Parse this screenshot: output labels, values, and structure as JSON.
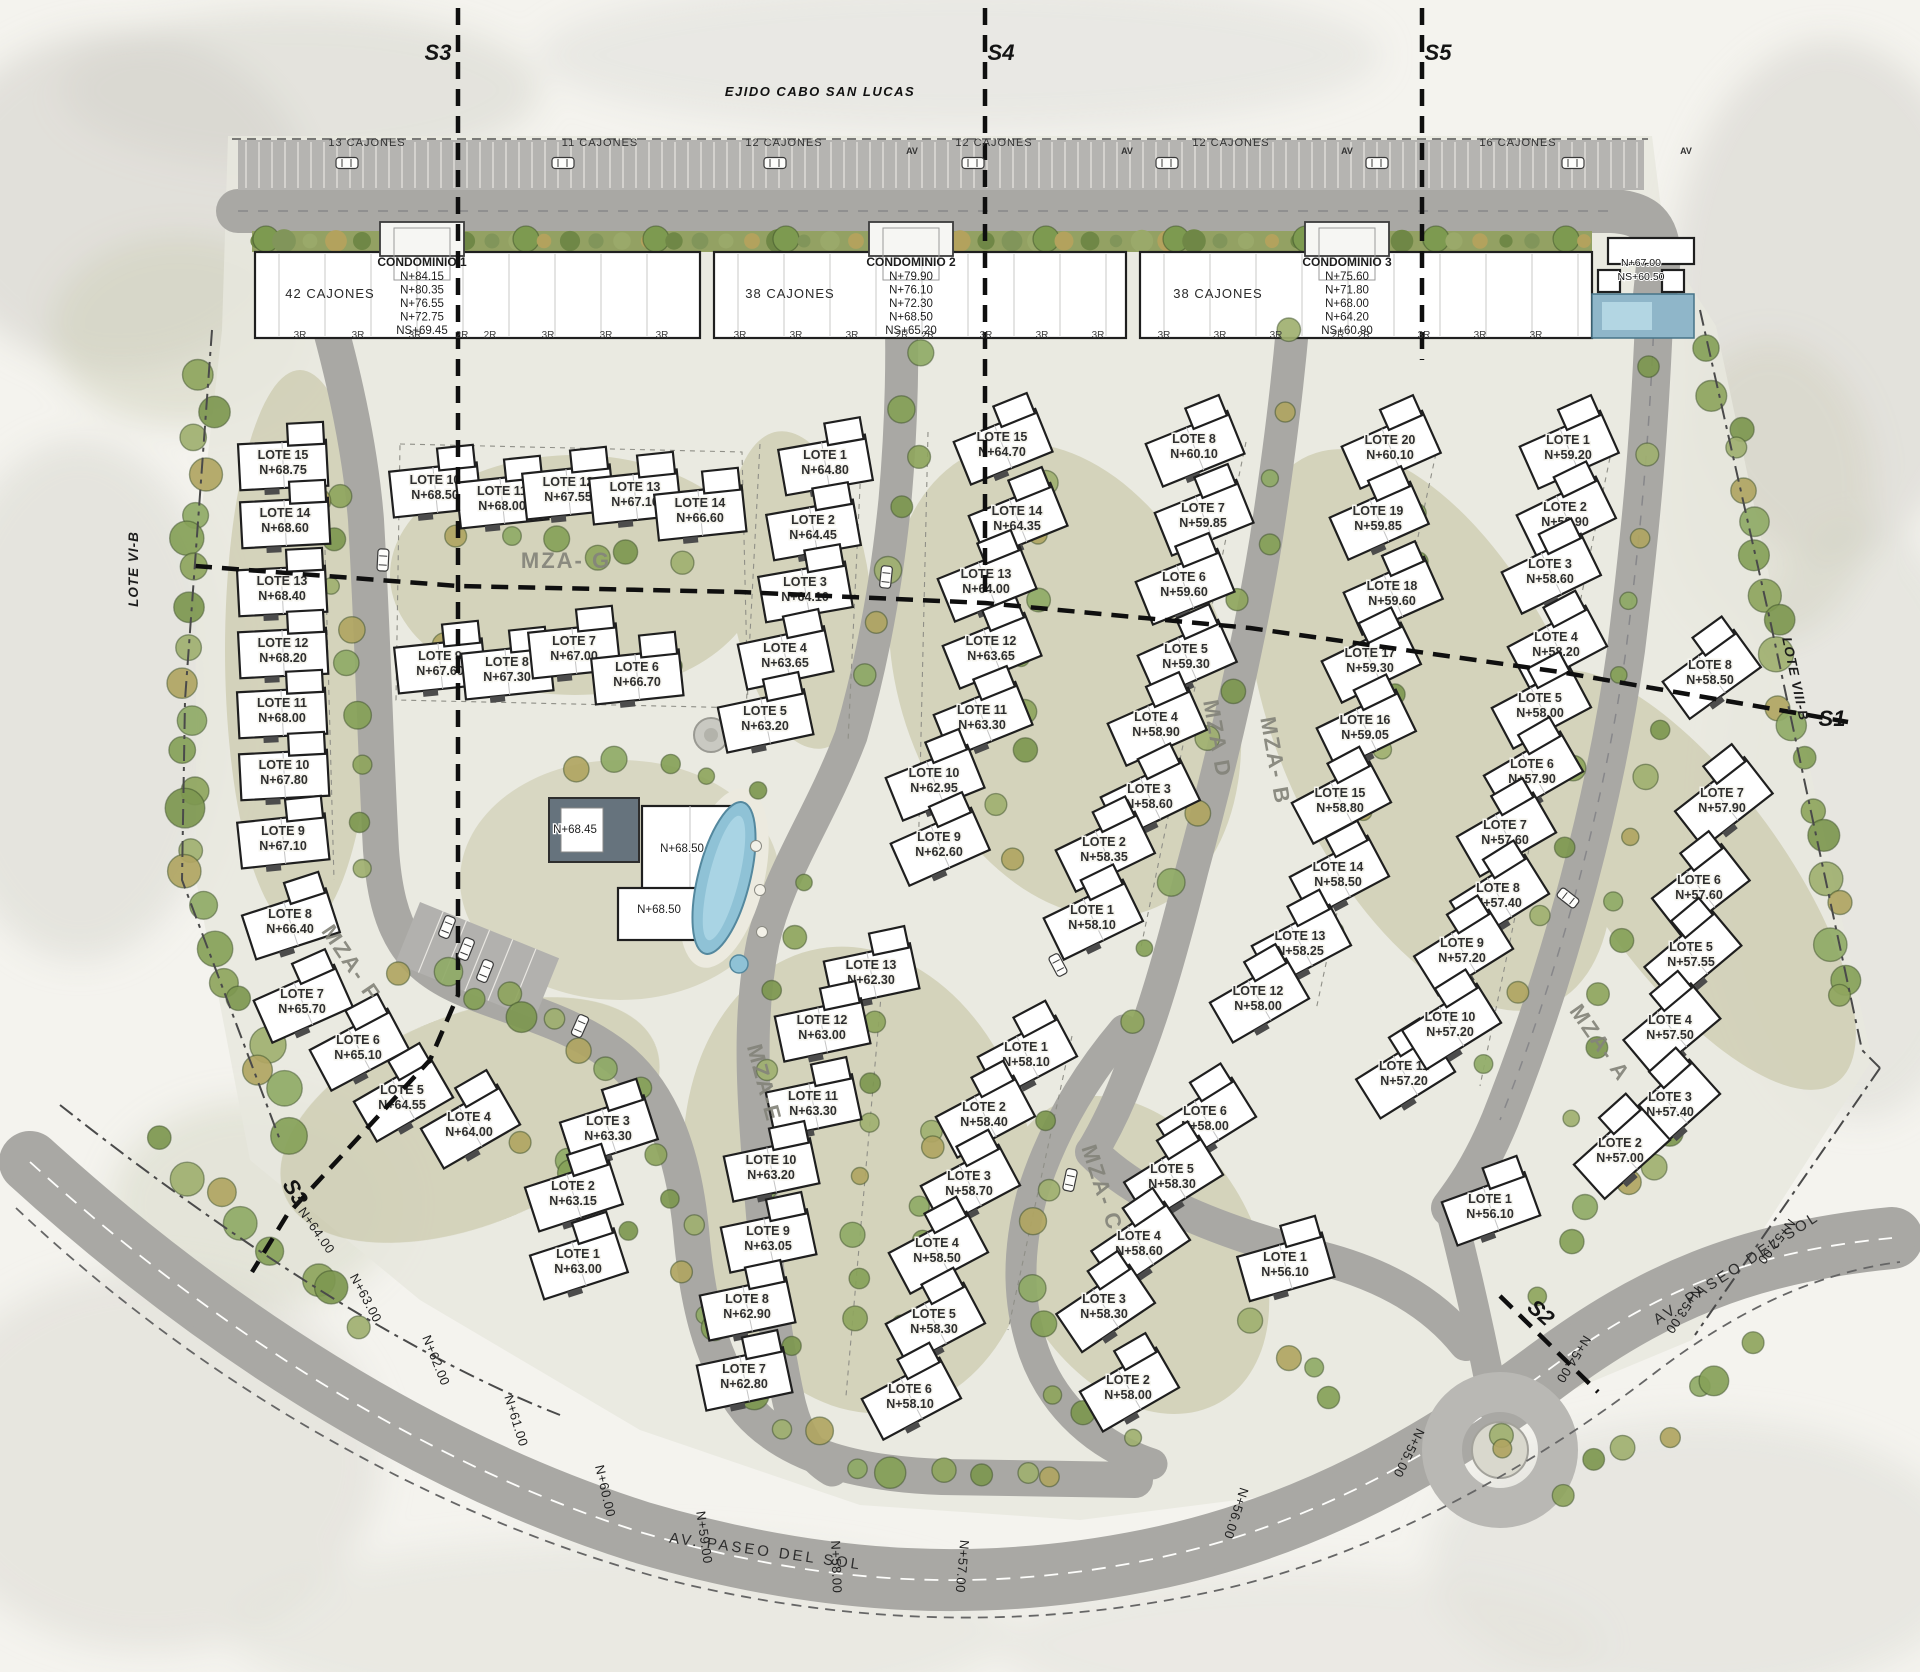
{
  "title": "EJIDO CABO SAN LUCAS",
  "colors": {
    "road": "#a9a8a4",
    "boulevard": "#b9b8b4",
    "pool_blue": "#8fc2d6",
    "tree_green": "#8fa55e",
    "building_white": "#ffffff"
  },
  "sections": [
    {
      "id": "S3-top",
      "label": "S3",
      "x": 438,
      "y": 60,
      "rot": 0
    },
    {
      "id": "S4-top",
      "label": "S4",
      "x": 1001,
      "y": 60,
      "rot": 0
    },
    {
      "id": "S5-top",
      "label": "S5",
      "x": 1438,
      "y": 60,
      "rot": 0
    },
    {
      "id": "S1-east",
      "label": "S1",
      "x": 1832,
      "y": 726,
      "rot": 0
    },
    {
      "id": "S2-south",
      "label": "S2",
      "x": 1536,
      "y": 1318,
      "rot": 42
    },
    {
      "id": "S3-bottom",
      "label": "S3",
      "x": 289,
      "y": 1196,
      "rot": 58
    }
  ],
  "boundaries": [
    {
      "label": "LOTE VI-B",
      "x": 138,
      "y": 569,
      "rot": -90
    },
    {
      "label": "LOTE VIII-B",
      "x": 1791,
      "y": 680,
      "rot": 78
    }
  ],
  "parking": {
    "row_y": 146,
    "labels": [
      {
        "text": "13 CAJONES",
        "x": 367
      },
      {
        "text": "11 CAJONES",
        "x": 600
      },
      {
        "text": "12 CAJONES",
        "x": 784
      },
      {
        "text": "12 CAJONES",
        "x": 994
      },
      {
        "text": "12 CAJONES",
        "x": 1231
      },
      {
        "text": "16 CAJONES",
        "x": 1518
      }
    ],
    "av_markers": [
      {
        "text": "AV",
        "x": 912
      },
      {
        "text": "AV",
        "x": 1127
      },
      {
        "text": "AV",
        "x": 1347
      },
      {
        "text": "AV",
        "x": 1686
      }
    ]
  },
  "condominiums": [
    {
      "name": "CONDOMINIO 1",
      "cajones_label": "42 CAJONES",
      "tower_x": 422,
      "cajones_x": 330,
      "levels": [
        "N+84.15",
        "N+80.35",
        "N+76.55",
        "N+72.75",
        "NS+69.45"
      ]
    },
    {
      "name": "CONDOMINIO 2",
      "cajones_label": "38 CAJONES",
      "tower_x": 911,
      "cajones_x": 790,
      "levels": [
        "N+79.90",
        "N+76.10",
        "N+72.30",
        "N+68.50",
        "NS+65.20"
      ]
    },
    {
      "name": "CONDOMINIO 3",
      "cajones_label": "38 CAJONES",
      "tower_x": 1347,
      "cajones_x": 1218,
      "levels": [
        "N+75.60",
        "N+71.80",
        "N+68.00",
        "N+64.20",
        "NS+60.90"
      ]
    }
  ],
  "floor_marks": {
    "y": 338,
    "items": [
      {
        "t": "3R",
        "x": 300
      },
      {
        "t": "3R",
        "x": 358
      },
      {
        "t": "3R",
        "x": 415
      },
      {
        "t": "2R",
        "x": 462
      },
      {
        "t": "2R",
        "x": 490
      },
      {
        "t": "3R",
        "x": 548
      },
      {
        "t": "3R",
        "x": 606
      },
      {
        "t": "3R",
        "x": 662
      },
      {
        "t": "3R",
        "x": 740
      },
      {
        "t": "3R",
        "x": 796
      },
      {
        "t": "3R",
        "x": 852
      },
      {
        "t": "2R",
        "x": 902
      },
      {
        "t": "2R",
        "x": 928
      },
      {
        "t": "3R",
        "x": 986
      },
      {
        "t": "3R",
        "x": 1042
      },
      {
        "t": "3R",
        "x": 1098
      },
      {
        "t": "3R",
        "x": 1164
      },
      {
        "t": "3R",
        "x": 1220
      },
      {
        "t": "3R",
        "x": 1276
      },
      {
        "t": "2R",
        "x": 1338
      },
      {
        "t": "2R",
        "x": 1364
      },
      {
        "t": "3R",
        "x": 1424
      },
      {
        "t": "3R",
        "x": 1480
      },
      {
        "t": "3R",
        "x": 1536
      }
    ]
  },
  "corner_building": {
    "x": 1641,
    "y": 266,
    "levels": [
      "N+67.00",
      "NS+60.50"
    ]
  },
  "amenity_labels": [
    {
      "text": "N+68.45",
      "x": 575,
      "y": 833
    },
    {
      "text": "N+68.50",
      "x": 682,
      "y": 852
    },
    {
      "text": "N+68.50",
      "x": 659,
      "y": 913
    }
  ],
  "manzanas": [
    {
      "name": "MZA- F",
      "label": {
        "x": 345,
        "y": 967,
        "rot": 56
      },
      "lots": [
        [
          15,
          "N+68.75",
          283,
          462,
          -3
        ],
        [
          14,
          "N+68.60",
          285,
          520,
          -3
        ],
        [
          13,
          "N+68.40",
          282,
          588,
          -3
        ],
        [
          12,
          "N+68.20",
          283,
          650,
          -3
        ],
        [
          11,
          "N+68.00",
          282,
          710,
          -3
        ],
        [
          10,
          "N+67.80",
          284,
          772,
          -3
        ],
        [
          9,
          "N+67.10",
          283,
          838,
          -6
        ],
        [
          8,
          "N+66.40",
          290,
          921,
          -18
        ],
        [
          7,
          "N+65.70",
          302,
          1001,
          -24
        ],
        [
          6,
          "N+65.10",
          358,
          1047,
          -28
        ],
        [
          5,
          "N+64.55",
          402,
          1097,
          -30
        ],
        [
          4,
          "N+64.00",
          469,
          1124,
          -30
        ],
        [
          3,
          "N+63.30",
          608,
          1128,
          -18
        ],
        [
          2,
          "N+63.15",
          573,
          1193,
          -18
        ],
        [
          1,
          "N+63.00",
          578,
          1261,
          -18
        ]
      ]
    },
    {
      "name": "MZA- G",
      "label": {
        "x": 566,
        "y": 568,
        "rot": 0
      },
      "lots": [
        [
          10,
          "N+68.50",
          435,
          487,
          -6
        ],
        [
          11,
          "N+68.00",
          502,
          498,
          -6
        ],
        [
          12,
          "N+67.55",
          568,
          489,
          -6
        ],
        [
          13,
          "N+67.10",
          635,
          494,
          -6
        ],
        [
          14,
          "N+66.60",
          700,
          510,
          -6
        ],
        [
          9,
          "N+67.60",
          440,
          663,
          -6
        ],
        [
          8,
          "N+67.30",
          507,
          669,
          -6
        ],
        [
          7,
          "N+67.00",
          574,
          648,
          -6
        ],
        [
          6,
          "N+66.70",
          637,
          674,
          -6
        ],
        [
          1,
          "N+64.80",
          825,
          462,
          -10
        ],
        [
          2,
          "N+64.45",
          813,
          527,
          -10
        ],
        [
          3,
          "N+64.10",
          805,
          589,
          -10
        ],
        [
          4,
          "N+63.65",
          785,
          655,
          -12
        ],
        [
          5,
          "N+63.20",
          765,
          718,
          -12
        ]
      ]
    },
    {
      "name": "MZA D",
      "label": {
        "x": 1210,
        "y": 740,
        "rot": 80
      },
      "lots": [
        [
          15,
          "N+64.70",
          1002,
          444,
          -22
        ],
        [
          14,
          "N+64.35",
          1017,
          518,
          -22
        ],
        [
          13,
          "N+64.00",
          986,
          581,
          -22
        ],
        [
          12,
          "N+63.65",
          991,
          648,
          -22
        ],
        [
          11,
          "N+63.30",
          982,
          717,
          -22
        ],
        [
          10,
          "N+62.95",
          934,
          780,
          -22
        ],
        [
          9,
          "N+62.60",
          939,
          844,
          -24
        ],
        [
          8,
          "N+60.10",
          1194,
          446,
          -22
        ],
        [
          7,
          "N+59.85",
          1203,
          515,
          -22
        ],
        [
          6,
          "N+59.60",
          1184,
          584,
          -22
        ],
        [
          5,
          "N+59.30",
          1186,
          656,
          -24
        ],
        [
          4,
          "N+58.90",
          1156,
          724,
          -24
        ],
        [
          3,
          "N+58.60",
          1149,
          796,
          -26
        ],
        [
          2,
          "N+58.35",
          1104,
          849,
          -26
        ],
        [
          1,
          "N+58.10",
          1092,
          917,
          -26
        ]
      ]
    },
    {
      "name": "MZA- B",
      "label": {
        "x": 1268,
        "y": 762,
        "rot": 80
      },
      "lots": [
        [
          20,
          "N+60.10",
          1390,
          447,
          -24
        ],
        [
          19,
          "N+59.85",
          1378,
          518,
          -24
        ],
        [
          18,
          "N+59.60",
          1392,
          593,
          -24
        ],
        [
          17,
          "N+59.30",
          1370,
          660,
          -26
        ],
        [
          16,
          "N+59.05",
          1365,
          727,
          -26
        ],
        [
          15,
          "N+58.80",
          1340,
          800,
          -28
        ],
        [
          14,
          "N+58.50",
          1338,
          874,
          -28
        ],
        [
          13,
          "N+58.25",
          1300,
          943,
          -28
        ],
        [
          12,
          "N+58.00",
          1258,
          998,
          -30
        ],
        [
          11,
          "N+57.20",
          1404,
          1073,
          -32
        ],
        [
          1,
          "N+59.20",
          1568,
          447,
          -24
        ],
        [
          2,
          "N+58.90",
          1565,
          514,
          -26
        ],
        [
          3,
          "N+58.60",
          1550,
          571,
          -26
        ],
        [
          4,
          "N+58.20",
          1556,
          644,
          -28
        ],
        [
          5,
          "N+58.00",
          1540,
          705,
          -28
        ],
        [
          6,
          "N+57.90",
          1532,
          771,
          -30
        ],
        [
          7,
          "N+57.60",
          1505,
          832,
          -30
        ],
        [
          8,
          "N+57.40",
          1498,
          895,
          -32
        ],
        [
          9,
          "N+57.20",
          1462,
          950,
          -32
        ],
        [
          10,
          "N+57.20",
          1450,
          1024,
          -32
        ]
      ]
    },
    {
      "name": "MZA- A",
      "label": {
        "x": 1594,
        "y": 1047,
        "rot": 55
      },
      "lots": [
        [
          8,
          "N+58.50",
          1710,
          672,
          -36
        ],
        [
          7,
          "N+57.90",
          1722,
          800,
          -38
        ],
        [
          6,
          "N+57.60",
          1699,
          887,
          -38
        ],
        [
          5,
          "N+57.55",
          1691,
          954,
          -40
        ],
        [
          4,
          "N+57.50",
          1670,
          1027,
          -40
        ],
        [
          3,
          "N+57.40",
          1670,
          1104,
          -42
        ],
        [
          2,
          "N+57.00",
          1620,
          1150,
          -42
        ],
        [
          1,
          "N+56.10",
          1490,
          1206,
          -20
        ]
      ]
    },
    {
      "name": "MZA-E",
      "label": {
        "x": 757,
        "y": 1085,
        "rot": 75
      },
      "lots": [
        [
          13,
          "N+62.30",
          871,
          972,
          -12
        ],
        [
          12,
          "N+63.00",
          822,
          1027,
          -12
        ],
        [
          11,
          "N+63.30",
          813,
          1103,
          -12
        ],
        [
          10,
          "N+63.20",
          771,
          1167,
          -12
        ],
        [
          9,
          "N+63.05",
          768,
          1238,
          -12
        ],
        [
          8,
          "N+62.90",
          747,
          1306,
          -12
        ],
        [
          7,
          "N+62.80",
          744,
          1376,
          -12
        ],
        [
          1,
          "N+58.10",
          1026,
          1054,
          -28
        ],
        [
          2,
          "N+58.40",
          984,
          1114,
          -28
        ],
        [
          3,
          "N+58.70",
          969,
          1183,
          -28
        ],
        [
          4,
          "N+58.50",
          937,
          1250,
          -28
        ],
        [
          5,
          "N+58.30",
          934,
          1321,
          -28
        ],
        [
          6,
          "N+58.10",
          910,
          1396,
          -28
        ]
      ]
    },
    {
      "name": "MZA- C",
      "label": {
        "x": 1095,
        "y": 1190,
        "rot": 72
      },
      "lots": [
        [
          6,
          "N+58.00",
          1205,
          1118,
          -32
        ],
        [
          5,
          "N+58.30",
          1172,
          1176,
          -32
        ],
        [
          4,
          "N+58.60",
          1139,
          1243,
          -34
        ],
        [
          3,
          "N+58.30",
          1104,
          1306,
          -34
        ],
        [
          2,
          "N+58.00",
          1128,
          1387,
          -30
        ],
        [
          1,
          "N+56.10",
          1285,
          1264,
          -16
        ]
      ]
    }
  ],
  "avenue": {
    "name": "AV. PASEO DEL SOL",
    "name_marks": [
      {
        "x": 765,
        "y": 1556,
        "rot": 8
      },
      {
        "x": 1739,
        "y": 1272,
        "rot": -33
      }
    ],
    "elev_marks": [
      {
        "t": "N+64.00",
        "x": 313,
        "y": 1233,
        "rot": 55
      },
      {
        "t": "N+63.00",
        "x": 362,
        "y": 1300,
        "rot": 62
      },
      {
        "t": "N+62.00",
        "x": 432,
        "y": 1362,
        "rot": 68
      },
      {
        "t": "N+61.00",
        "x": 512,
        "y": 1422,
        "rot": 73
      },
      {
        "t": "N+60.00",
        "x": 601,
        "y": 1492,
        "rot": 77
      },
      {
        "t": "N+59.00",
        "x": 700,
        "y": 1538,
        "rot": 82
      },
      {
        "t": "N+58.00",
        "x": 832,
        "y": 1567,
        "rot": 88
      },
      {
        "t": "N+57.00",
        "x": 958,
        "y": 1566,
        "rot": 95
      },
      {
        "t": "N+56.00",
        "x": 1232,
        "y": 1512,
        "rot": 108
      },
      {
        "t": "N+55.00",
        "x": 1405,
        "y": 1451,
        "rot": 117
      },
      {
        "t": "N+54.00",
        "x": 1570,
        "y": 1357,
        "rot": 122
      },
      {
        "t": "N+53.00",
        "x": 1680,
        "y": 1308,
        "rot": 124
      },
      {
        "t": "N+52.00",
        "x": 1773,
        "y": 1239,
        "rot": 127
      }
    ]
  },
  "decorations": {
    "cars": [
      [
        347,
        163,
        90
      ],
      [
        563,
        163,
        90
      ],
      [
        775,
        163,
        90
      ],
      [
        973,
        163,
        90
      ],
      [
        1167,
        163,
        90
      ],
      [
        1377,
        163,
        90
      ],
      [
        1573,
        163,
        90
      ],
      [
        383,
        560,
        3
      ],
      [
        886,
        577,
        6
      ],
      [
        1568,
        898,
        -52
      ],
      [
        1070,
        1180,
        12
      ],
      [
        580,
        1026,
        24
      ],
      [
        1058,
        965,
        -28
      ],
      [
        447,
        927,
        22
      ],
      [
        466,
        949,
        22
      ],
      [
        485,
        971,
        22
      ]
    ]
  }
}
